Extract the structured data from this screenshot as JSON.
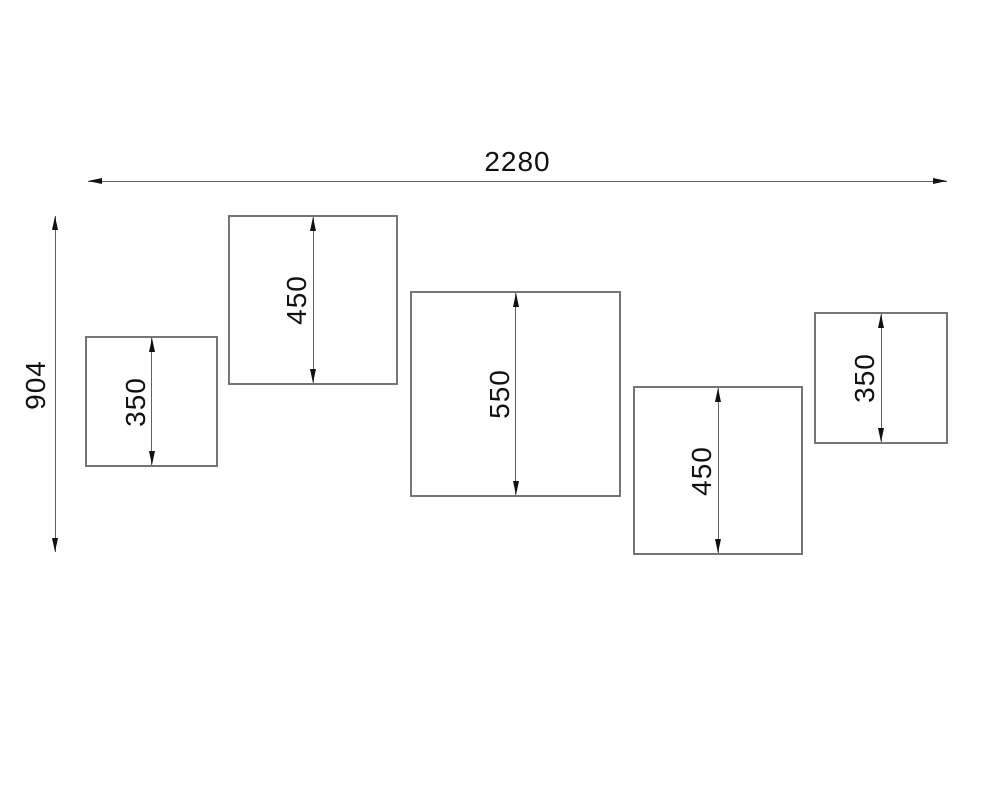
{
  "drawing": {
    "overall": {
      "width_label": "2280",
      "height_label": "904"
    },
    "panels": [
      {
        "id": "panel-1",
        "size_label": "350"
      },
      {
        "id": "panel-2",
        "size_label": "450"
      },
      {
        "id": "panel-3",
        "size_label": "550"
      },
      {
        "id": "panel-4",
        "size_label": "450"
      },
      {
        "id": "panel-5",
        "size_label": "350"
      }
    ],
    "colors": {
      "background": "#ffffff",
      "panel_border": "#757575",
      "dimension_line": "#5f5f5f",
      "arrow": "#111111",
      "text": "#111111"
    }
  }
}
